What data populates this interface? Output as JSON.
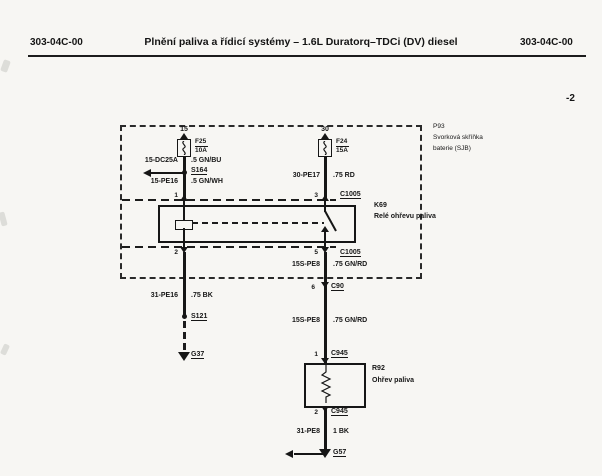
{
  "header": {
    "left_code": "303-04C-00",
    "title": "Plnění paliva a řídicí systémy – 1.6L Duratorq–TDCi (DV) diesel",
    "right_code": "303-04C-00"
  },
  "page_marker": "-2",
  "colors": {
    "ink": "#161616",
    "paper": "#f7f6f3"
  },
  "diagram": {
    "junction_box": {
      "id": "P93",
      "name_line1": "Svorková skříňka",
      "name_line2": "baterie (SJB)"
    },
    "fuse15": {
      "terminal": "15",
      "id": "F25",
      "rating": "10A"
    },
    "fuse30": {
      "terminal": "30",
      "id": "F24",
      "rating": "15A"
    },
    "wire_15dc25a": {
      "circuit": "15-DC25A",
      "spec": ".5 GN/BU"
    },
    "wire_15pe16": {
      "circuit": "15-PE16",
      "spec": ".5 GN/WH"
    },
    "wire_30pe17": {
      "circuit": "30-PE17",
      "spec": ".75 RD"
    },
    "wire_15spe8_upper": {
      "circuit": "15S-PE8",
      "spec": ".75 GN/RD"
    },
    "wire_15spe8_lower": {
      "circuit": "15S-PE8",
      "spec": ".75 GN/RD"
    },
    "wire_31pe16": {
      "circuit": "31-PE16",
      "spec": ".75 BK"
    },
    "wire_31pe8": {
      "circuit": "31-PE8",
      "spec": "1 BK"
    },
    "splice_s164": "S164",
    "splice_s121": "S121",
    "relay": {
      "id": "K69",
      "name": "Relé ohřevu paliva",
      "pin1": "1",
      "pin2": "2",
      "pin3": "3",
      "pin5": "5",
      "connector_top": "C1005",
      "connector_bottom": "C1005"
    },
    "connector_c90": {
      "pin": "6",
      "id": "C90"
    },
    "heater": {
      "id": "R92",
      "name": "Ohřev paliva",
      "pin_top": "1",
      "pin_bottom": "2",
      "connector_top": "C945",
      "connector_bottom": "C945"
    },
    "ground_g37": "G37",
    "ground_g57": "G57"
  }
}
